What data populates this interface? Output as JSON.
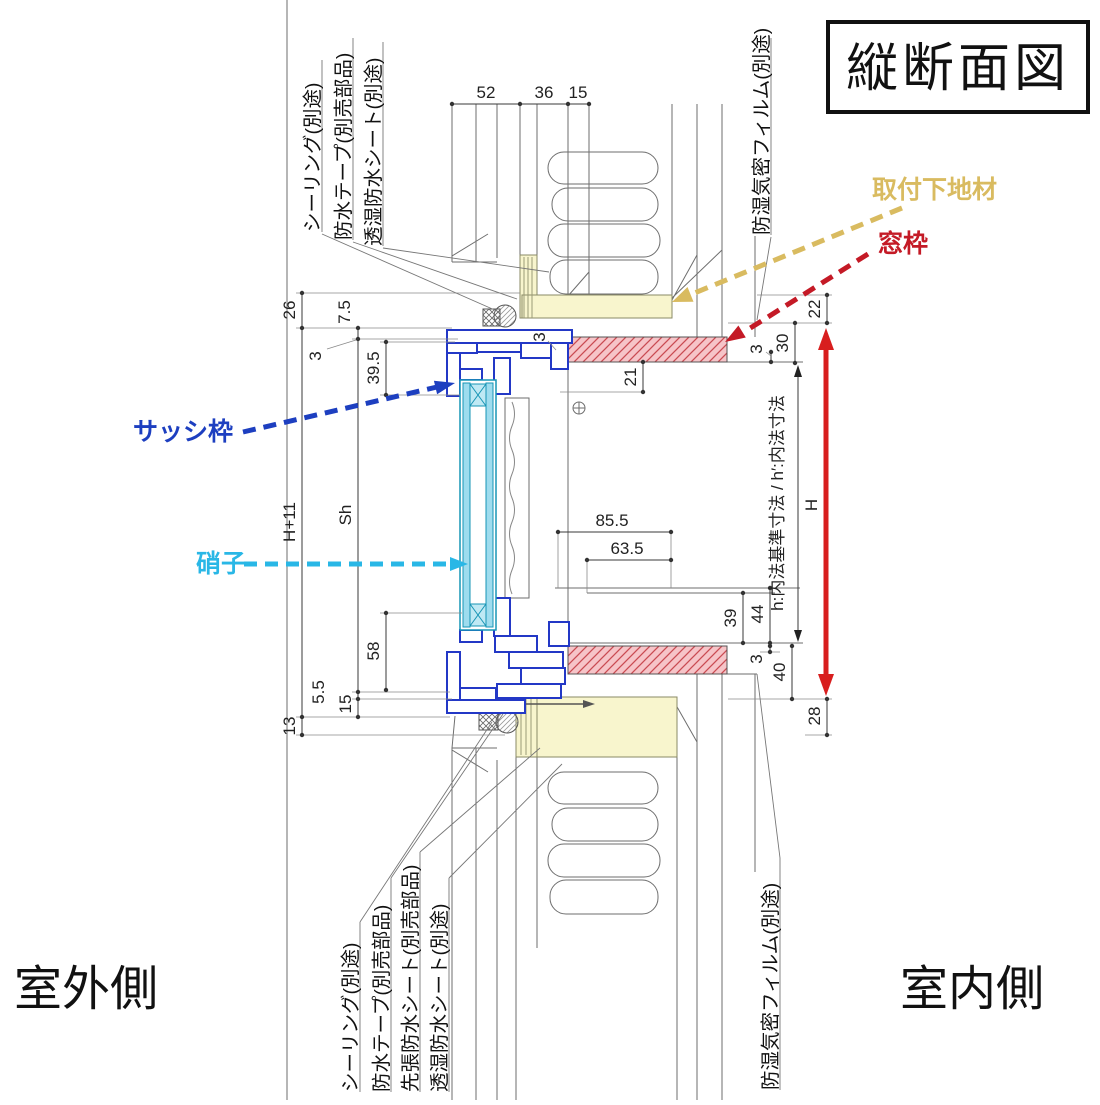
{
  "title": "縦断面図",
  "sides": {
    "outdoor": "室外側",
    "indoor": "室内側"
  },
  "callouts": {
    "mounting_base": {
      "label": "取付下地材",
      "color": "#d9bb60"
    },
    "window_frame": {
      "label": "窓枠",
      "color": "#c41a26"
    },
    "sash_frame": {
      "label": "サッシ枠",
      "color": "#1d3fc0"
    },
    "glass": {
      "label": "硝子",
      "color": "#29b7e6"
    }
  },
  "h_arrow": {
    "label": "H",
    "color": "#d81e1e"
  },
  "materials_top": {
    "sealing": "シーリング(別途)",
    "tape": "防水テープ(別売部品)",
    "sheet": "透湿防水シート(別途)",
    "film": "防湿気密フィルム(別途)"
  },
  "materials_bottom": {
    "sealing": "シーリング(別途)",
    "tape": "防水テープ(別売部品)",
    "pre_sheet": "先張防水シート(別売部品)",
    "sheet": "透湿防水シート(別途)",
    "film": "防湿気密フィルム(別途)"
  },
  "dims": {
    "w52": "52",
    "w36": "36",
    "w15": "15",
    "d26": "26",
    "d75": "7.5",
    "d3_left": "3",
    "d395": "39.5",
    "h_plus_11": "H+11",
    "sh": "Sh",
    "d58": "58",
    "d55": "5.5",
    "d15": "15",
    "d13": "13",
    "d855": "85.5",
    "d635": "63.5",
    "d21": "21",
    "d3_mid": "3",
    "d22": "22",
    "d30": "30",
    "d3_top_right": "3",
    "d39": "39",
    "d44": "44",
    "d3_bot_right": "3",
    "d40": "40",
    "d28": "28",
    "h_note": "h:内法基準寸法 / h′:内法寸法"
  }
}
